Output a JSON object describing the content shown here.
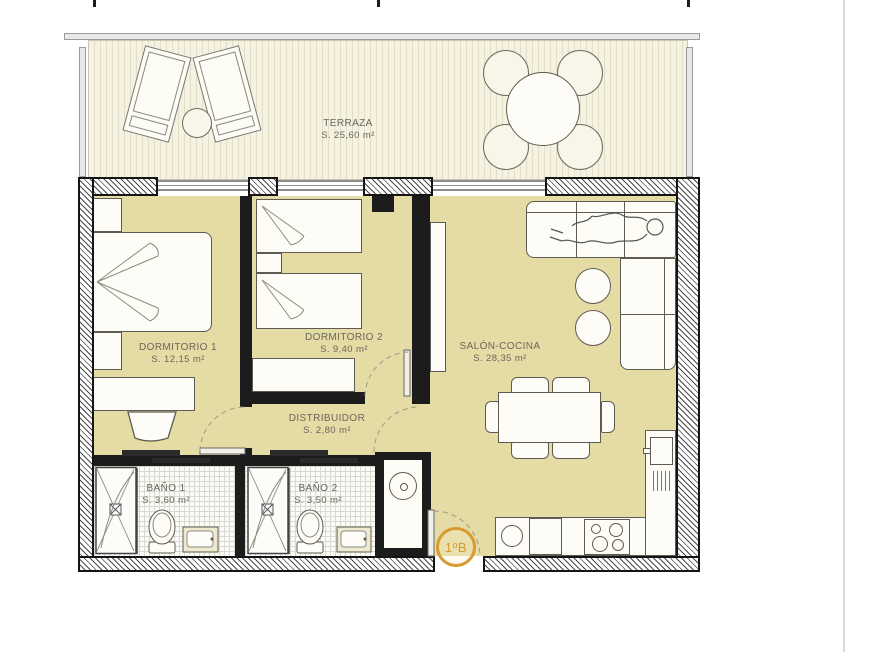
{
  "plan": {
    "unit_badge": "1ºB",
    "rooms": {
      "terraza": {
        "name": "TERRAZA",
        "area": "S. 25,60 m²"
      },
      "dormitorio1": {
        "name": "DORMITORIO 1",
        "area": "S. 12,15 m²"
      },
      "dormitorio2": {
        "name": "DORMITORIO 2",
        "area": "S. 9,40 m²"
      },
      "salon": {
        "name": "SALÓN-COCINA",
        "area": "S. 28,35 m²"
      },
      "distribuidor": {
        "name": "DISTRIBUIDOR",
        "area": "S. 2,80 m²"
      },
      "bano1": {
        "name": "BAÑO 1",
        "area": "S. 3,60 m²"
      },
      "bano2": {
        "name": "BAÑO 2",
        "area": "S. 3,50 m²"
      }
    },
    "colors": {
      "interior_floor": "#e5dba5",
      "terrace_floor": "#f5f2df",
      "wall": "#1c1c1c",
      "accent_orange": "#d79a2f",
      "label_text": "#6a675c"
    }
  }
}
